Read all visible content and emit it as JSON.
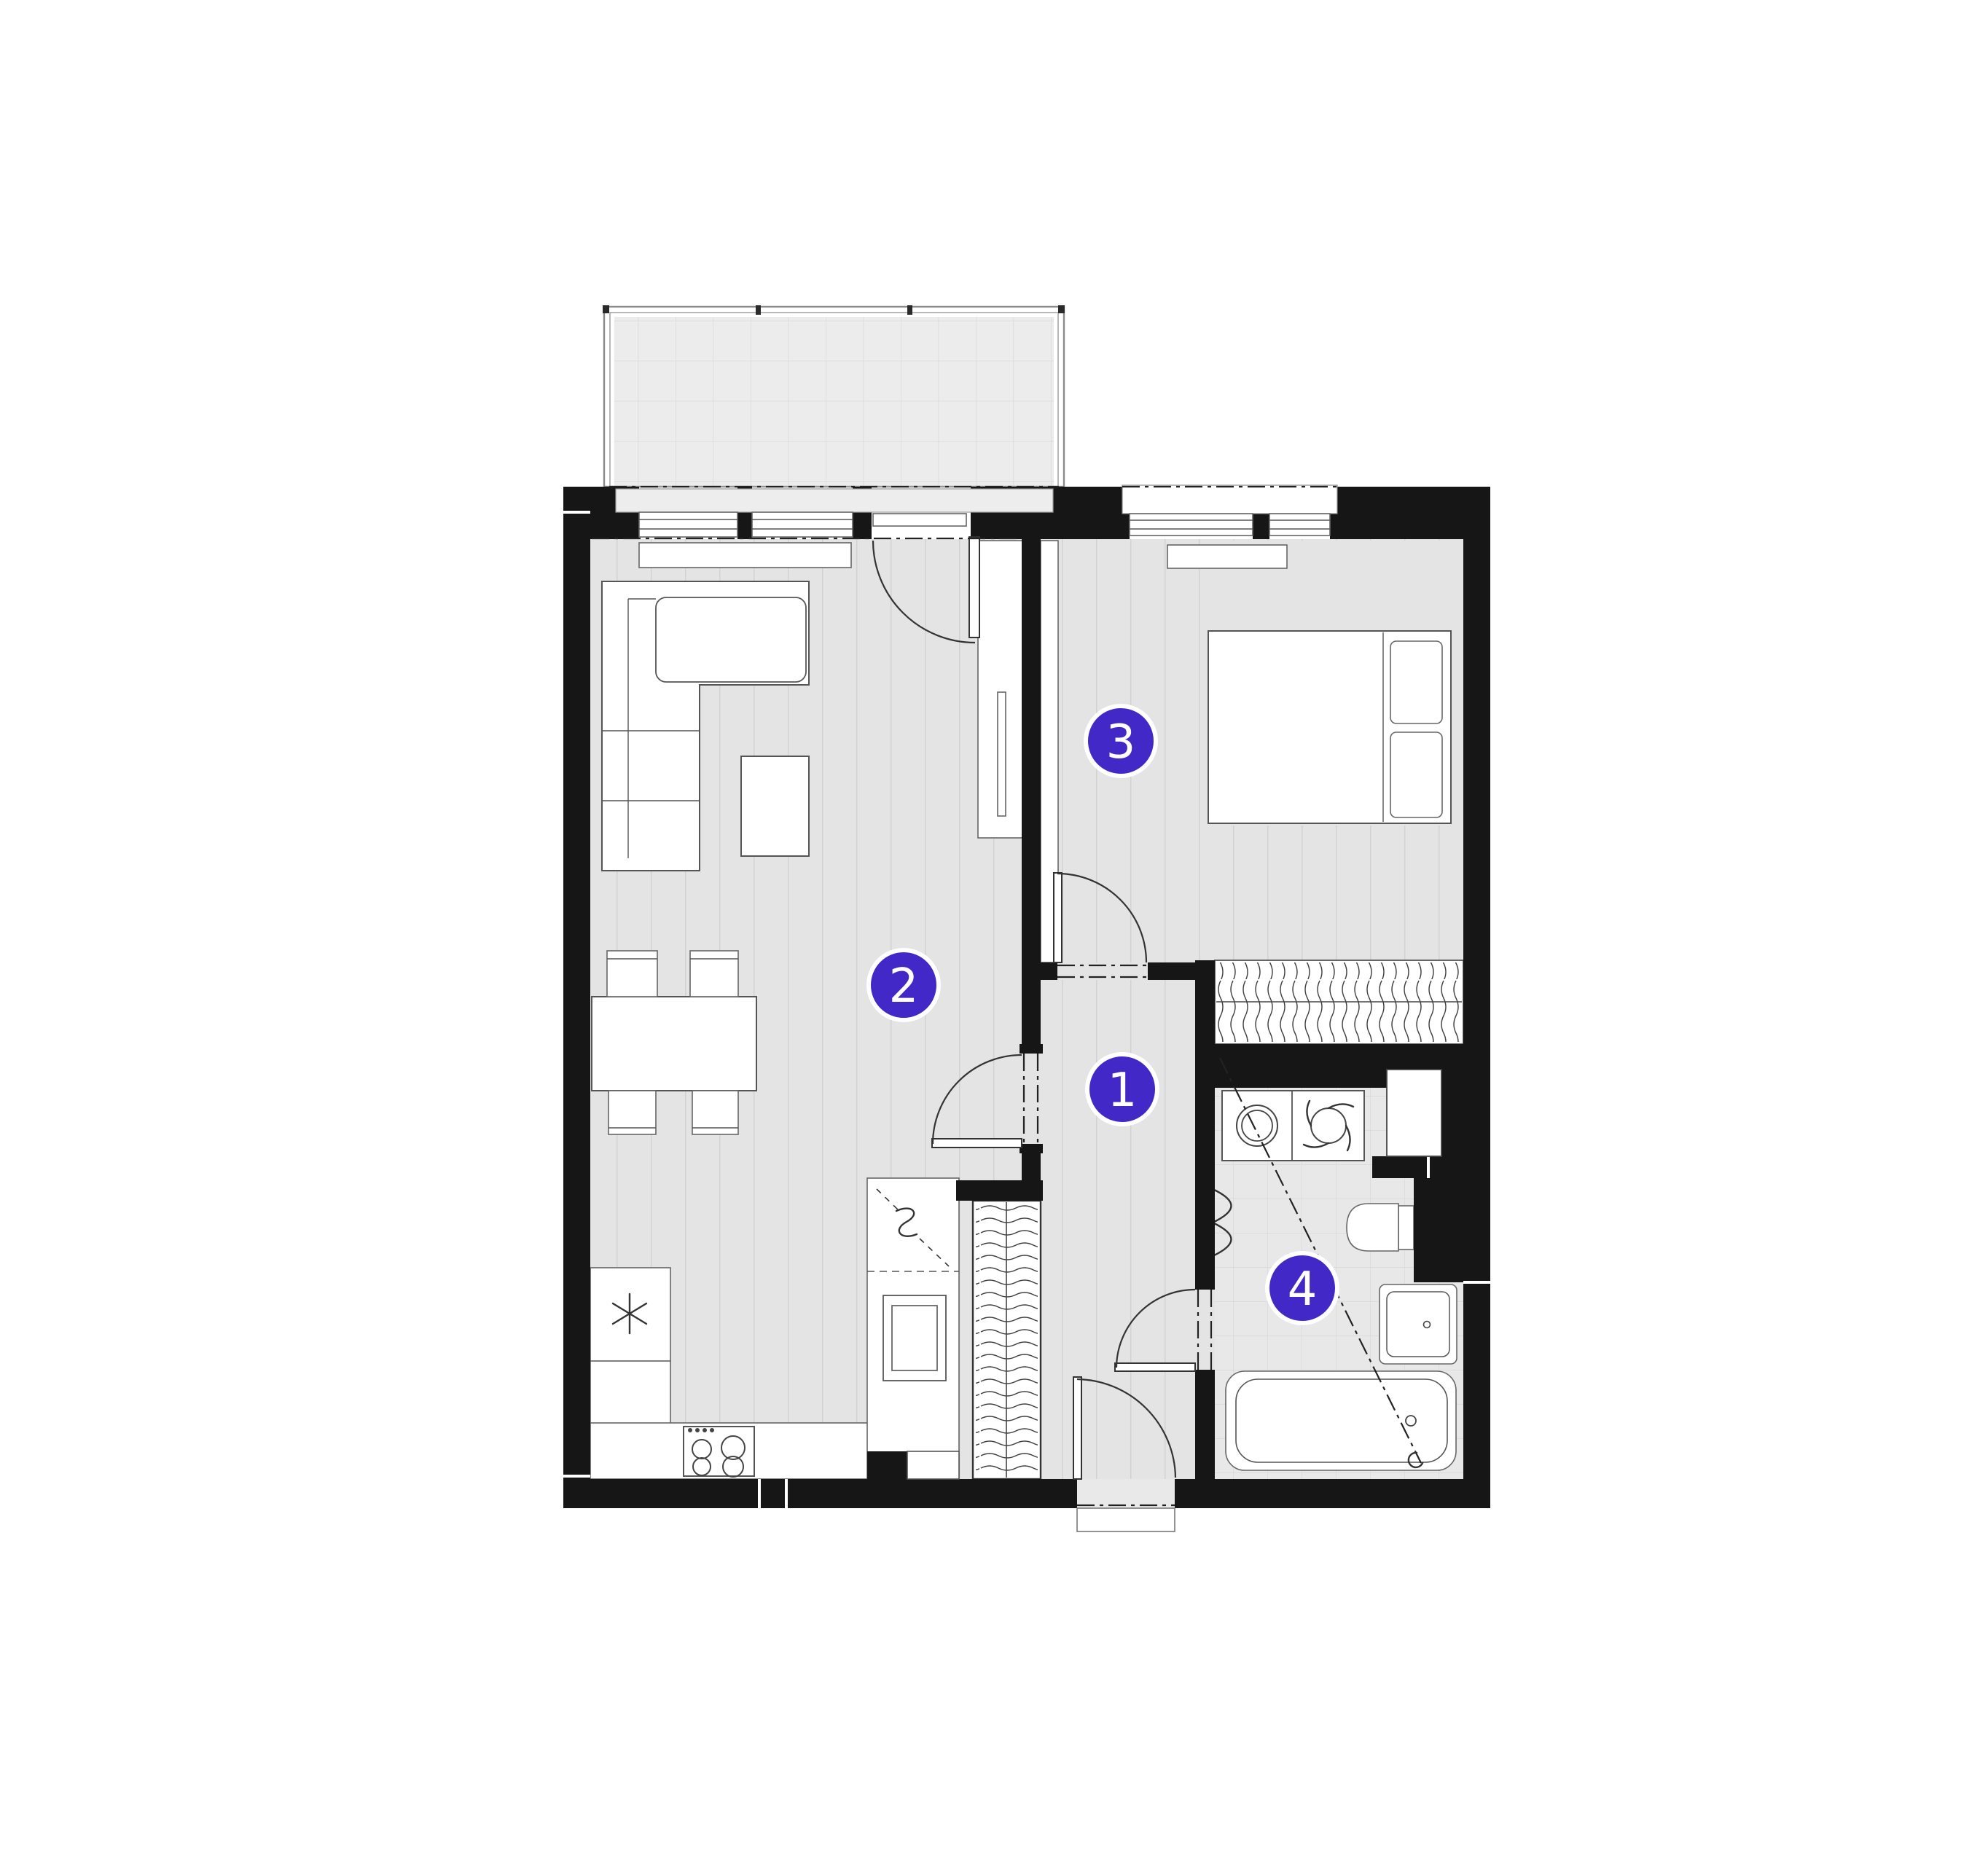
{
  "plan": {
    "title": "apartment-floor-plan",
    "room_labels": [
      {
        "number": "1",
        "room": "hallway"
      },
      {
        "number": "2",
        "room": "living-room-with-kitchen"
      },
      {
        "number": "3",
        "room": "bedroom"
      },
      {
        "number": "4",
        "room": "bathroom"
      }
    ],
    "colors": {
      "accent": "#4328c8",
      "wall": "#161616",
      "floor": "#e4e4e4",
      "balcony_floor": "#ececec",
      "fixture_outline": "#555555"
    },
    "icons": [
      "washing-machine-icon",
      "tap-icon",
      "stove-burners-icon",
      "fridge-asterisk-icon",
      "wardrobe-hatch-icon"
    ]
  }
}
